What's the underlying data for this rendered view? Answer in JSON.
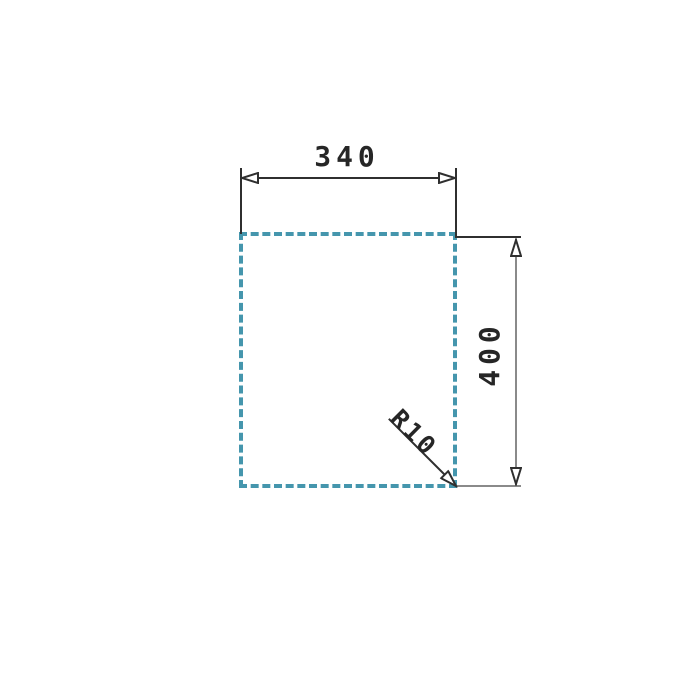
{
  "drawing": {
    "title": "rectangular-cutout-dimension-drawing",
    "width_dim": {
      "label": "340"
    },
    "height_dim": {
      "label": "400"
    },
    "radius_dim": {
      "label": "R10"
    },
    "colors": {
      "line_dark": "#2f2f2f",
      "line_gray": "#8a8a8a",
      "dash_color": "#4596ad",
      "text_color": "#262626",
      "background": "#ffffff"
    }
  }
}
